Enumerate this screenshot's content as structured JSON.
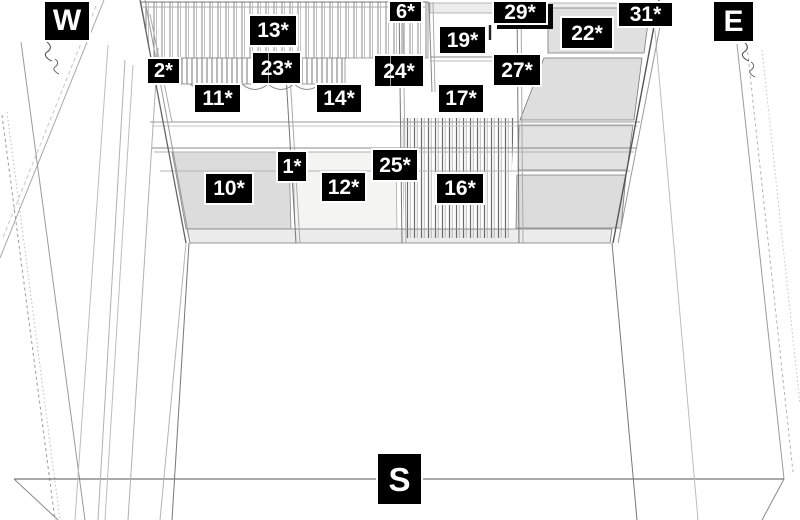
{
  "scene": {
    "description": "3D perspective line drawing of a hall interior viewed toward the ceiling canopy, with numbered asterisk position tags",
    "background": "#ffffff"
  },
  "colors": {
    "label_bg": "#000000",
    "label_text": "#ffffff",
    "label_halo": "#ffffff",
    "line_dark": "#555555",
    "line_mid": "#888888",
    "line_light": "#bbbbbb",
    "panel_gray": "#dcdcdc",
    "fascia_gray": "#ececec"
  },
  "compass": {
    "west": "W",
    "east": "E",
    "south": "S"
  },
  "markers": [
    {
      "id": "6",
      "text": "6*"
    },
    {
      "id": "29",
      "text": "29*"
    },
    {
      "id": "31",
      "text": "31*"
    },
    {
      "id": "13",
      "text": "13*"
    },
    {
      "id": "19",
      "text": "19*"
    },
    {
      "id": "22",
      "text": "22*"
    },
    {
      "id": "2",
      "text": "2*"
    },
    {
      "id": "23",
      "text": "23*"
    },
    {
      "id": "24",
      "text": "24*"
    },
    {
      "id": "27",
      "text": "27*"
    },
    {
      "id": "11",
      "text": "11*"
    },
    {
      "id": "14",
      "text": "14*"
    },
    {
      "id": "17",
      "text": "17*"
    },
    {
      "id": "1",
      "text": "1*"
    },
    {
      "id": "25",
      "text": "25*"
    },
    {
      "id": "10",
      "text": "10*"
    },
    {
      "id": "12",
      "text": "12*"
    },
    {
      "id": "16",
      "text": "16*"
    }
  ]
}
